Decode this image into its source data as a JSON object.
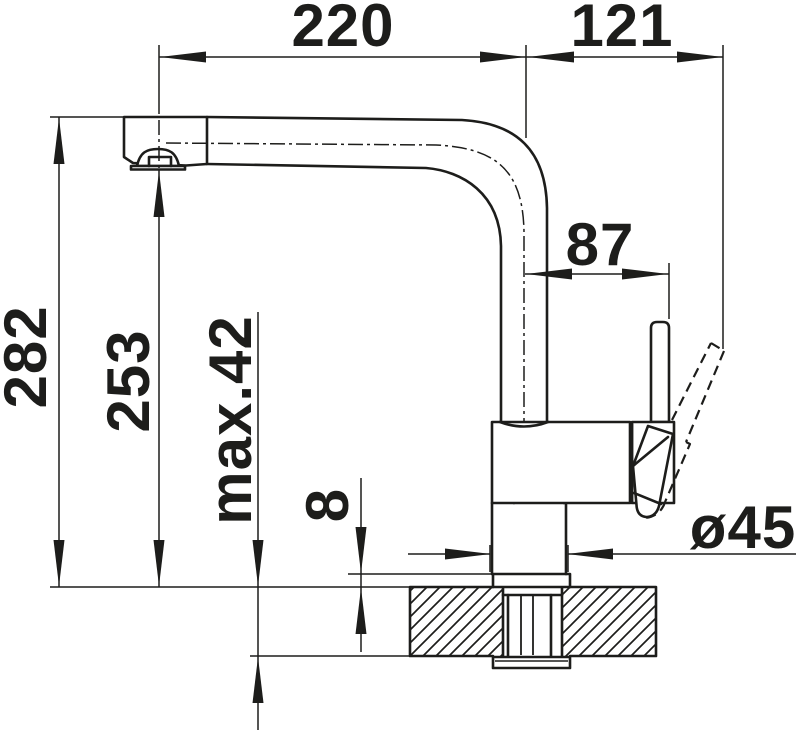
{
  "drawing": {
    "kind": "technical dimension drawing",
    "colors": {
      "line": "#1d1d1b",
      "background": "#ffffff"
    }
  },
  "dimensions": {
    "spout_reach": {
      "value": "220"
    },
    "rear_extension": {
      "value": "121"
    },
    "handle_projection": {
      "value": "87"
    },
    "overall_height": {
      "value": "282"
    },
    "outlet_height": {
      "value": "253"
    },
    "max_mounting_thickness": {
      "value": "max.42"
    },
    "deck_plate_height": {
      "value": "8"
    },
    "base_diameter": {
      "value": "ø45"
    }
  }
}
